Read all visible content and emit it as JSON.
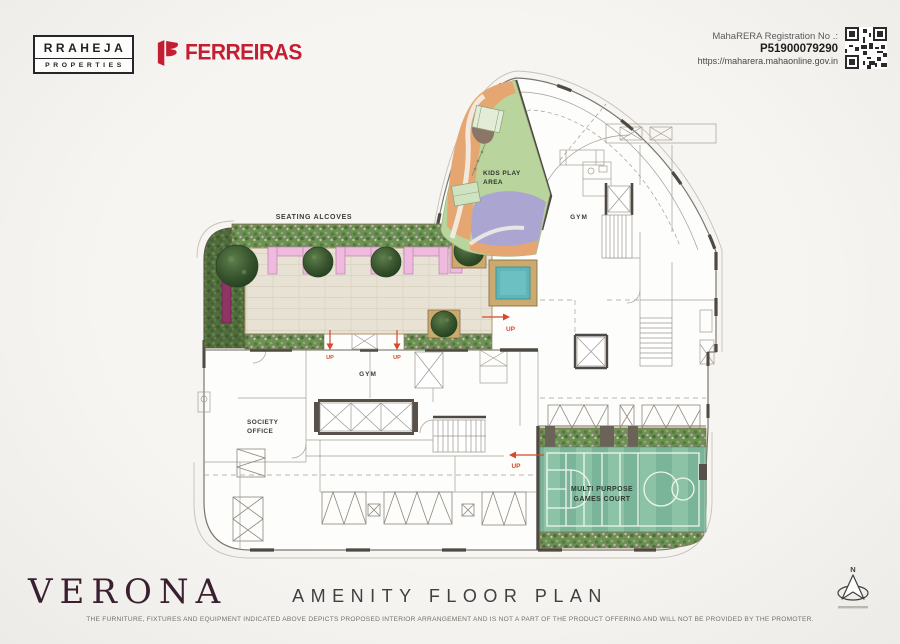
{
  "header": {
    "raheja_line1": "RRAHEJA",
    "raheja_line2": "PROPERTIES",
    "ferreiras": "FERREIRAS",
    "rera_label": "MahaRERA Registration No .:",
    "rera_number": "P51900079290",
    "rera_url": "https://maharera.mahaonline.gov.in"
  },
  "plan": {
    "seating_alcoves": "SEATING ALCOVES",
    "kids_play_line1": "KIDS PLAY",
    "kids_play_line2": "AREA",
    "gym_upper": "GYM",
    "gym_lower": "GYM",
    "society_line1": "SOCIETY",
    "society_line2": "OFFICE",
    "court_line1": "MULTI PURPOSE",
    "court_line2": "GAMES COURT",
    "up": "UP"
  },
  "footer": {
    "project": "VERONA",
    "title": "AMENITY FLOOR PLAN",
    "disclaimer": "THE FURNITURE, FIXTURES AND EQUIPMENT INDICATED ABOVE DEPICTS PROPOSED INTERIOR ARRANGEMENT AND IS NOT A PART OF THE PRODUCT OFFERING AND WILL NOT BE PROVIDED BY THE PROMOTER.",
    "north": "N"
  },
  "colors": {
    "brand_red": "#c41e33",
    "verona_maroon": "#3a1f31",
    "up_red": "#d6492a",
    "hedge_green": "#55713f",
    "court_green_a": "#8cc3a6",
    "court_green_b": "#7ab59a",
    "alcove_pink": "#eebade",
    "floor_beige": "#e8e2d4",
    "water_teal": "#5fb6ba",
    "wall_dark": "#4e4942"
  }
}
